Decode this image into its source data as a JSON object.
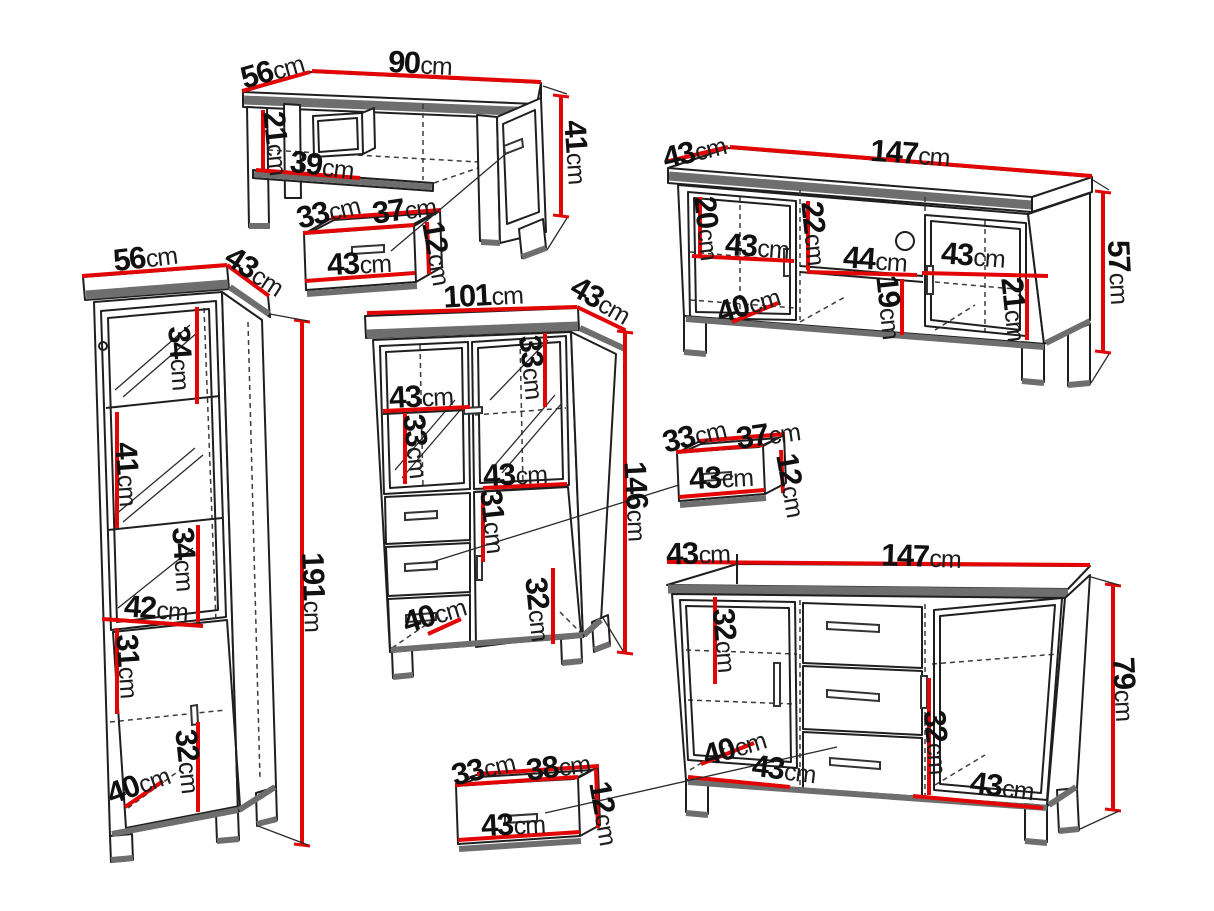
{
  "unit": "cm",
  "diagram_title": "furniture set dimension diagram",
  "furniture": {
    "coffee_table": {
      "depth": "56",
      "width": "90",
      "height": "41",
      "inner_height": "21",
      "inner_width": "39"
    },
    "drawer_box_1": {
      "depth": "33",
      "top_width": "37",
      "front_width": "43",
      "height": "12"
    },
    "tv_stand": {
      "depth": "43",
      "width": "147",
      "height": "57",
      "left_inner_height": "20",
      "left_inner_width": "43",
      "mid_inner_height": "22",
      "mid_inner_width": "44",
      "right_inner_width": "43",
      "bottom_depth": "40",
      "mid_lower_height": "19",
      "right_lower_height": "21"
    },
    "tall_display_cabinet": {
      "width": "56",
      "depth": "43",
      "height": "191",
      "top_section_height": "34",
      "second_section_height": "41",
      "third_section_height": "34",
      "inner_width": "42",
      "fourth_section_height": "31",
      "bottom_section_height": "32",
      "bottom_depth": "40"
    },
    "glass_cabinet": {
      "width": "101",
      "depth": "43",
      "height": "146",
      "left_shelf_width": "43",
      "left_section_height": "33",
      "right_section_height": "33",
      "mid_shelf_width": "43",
      "drawer_section_height": "31",
      "bottom_section_height": "32",
      "bottom_depth": "40"
    },
    "drawer_box_2": {
      "depth": "33",
      "top_width": "37",
      "front_width": "43",
      "height": "12"
    },
    "sideboard": {
      "depth": "43",
      "width": "147",
      "height": "79",
      "left_inner_height": "32",
      "right_inner_height": "32",
      "bottom_depth": "40",
      "bottom_left_width": "43",
      "bottom_right_width": "43"
    },
    "drawer_box_3": {
      "depth": "33",
      "top_width": "38",
      "front_width": "43",
      "height": "12"
    }
  }
}
